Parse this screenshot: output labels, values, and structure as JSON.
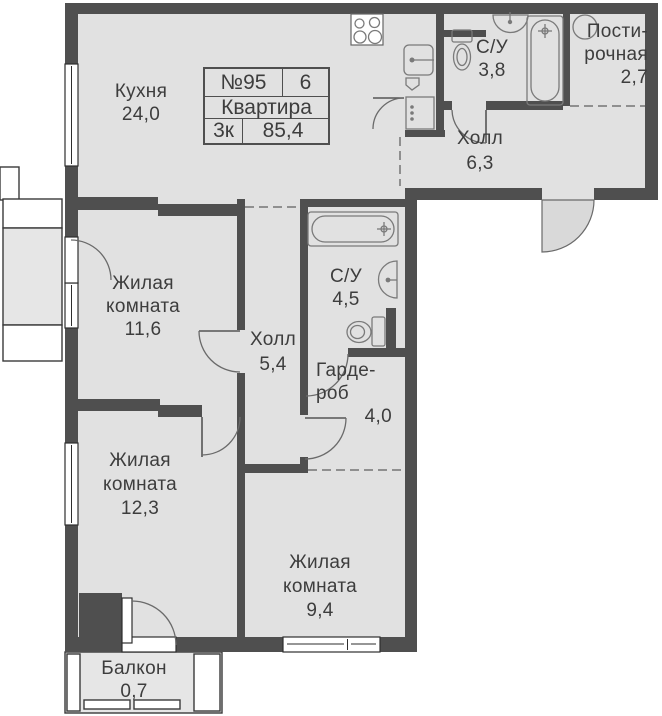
{
  "title": "План квартиры",
  "info_table": {
    "number": "№95",
    "floor": "6",
    "kind": "Квартира",
    "rooms": "3к",
    "area_total": "85,4"
  },
  "rooms": {
    "kitchen": {
      "l1": "Кухня",
      "l2": "24,0"
    },
    "bathroom_top": {
      "l1": "С/У",
      "l2": "3,8"
    },
    "laundry": {
      "l1": "Пости-",
      "l2": "рочная",
      "l3": "2,7"
    },
    "hall_top": {
      "l1": "Холл",
      "l2": "6,3"
    },
    "living_1": {
      "l1": "Жилая",
      "l2": "комната",
      "l3": "11,6"
    },
    "hall_mid": {
      "l1": "Холл",
      "l2": "5,4"
    },
    "bathroom_mid": {
      "l1": "С/У",
      "l2": "4,5"
    },
    "wardrobe": {
      "l1": "Гарде-",
      "l2": "роб",
      "l3": "4,0"
    },
    "living_2": {
      "l1": "Жилая",
      "l2": "комната",
      "l3": "12,3"
    },
    "living_3": {
      "l1": "Жилая",
      "l2": "комната",
      "l3": "9,4"
    },
    "balcony": {
      "l1": "Балкон",
      "l2": "0,7"
    }
  },
  "fixtures": {
    "kitchen": [
      "stove",
      "sink",
      "cabinet"
    ],
    "bathroom_top": [
      "toilet",
      "wash-basin",
      "bathtub"
    ],
    "laundry": [
      "washing-machine"
    ],
    "bathroom_mid": [
      "bathtub",
      "wash-basin",
      "toilet"
    ]
  },
  "colors": {
    "wall": "#4f4f4f",
    "floor": "#e1e1e1",
    "swing": "#d9d9d9",
    "fixture": "#7a7a7a",
    "dash": "#8f8f8f",
    "window-frame": "#2e2e2e",
    "text": "#3d3d3d"
  }
}
